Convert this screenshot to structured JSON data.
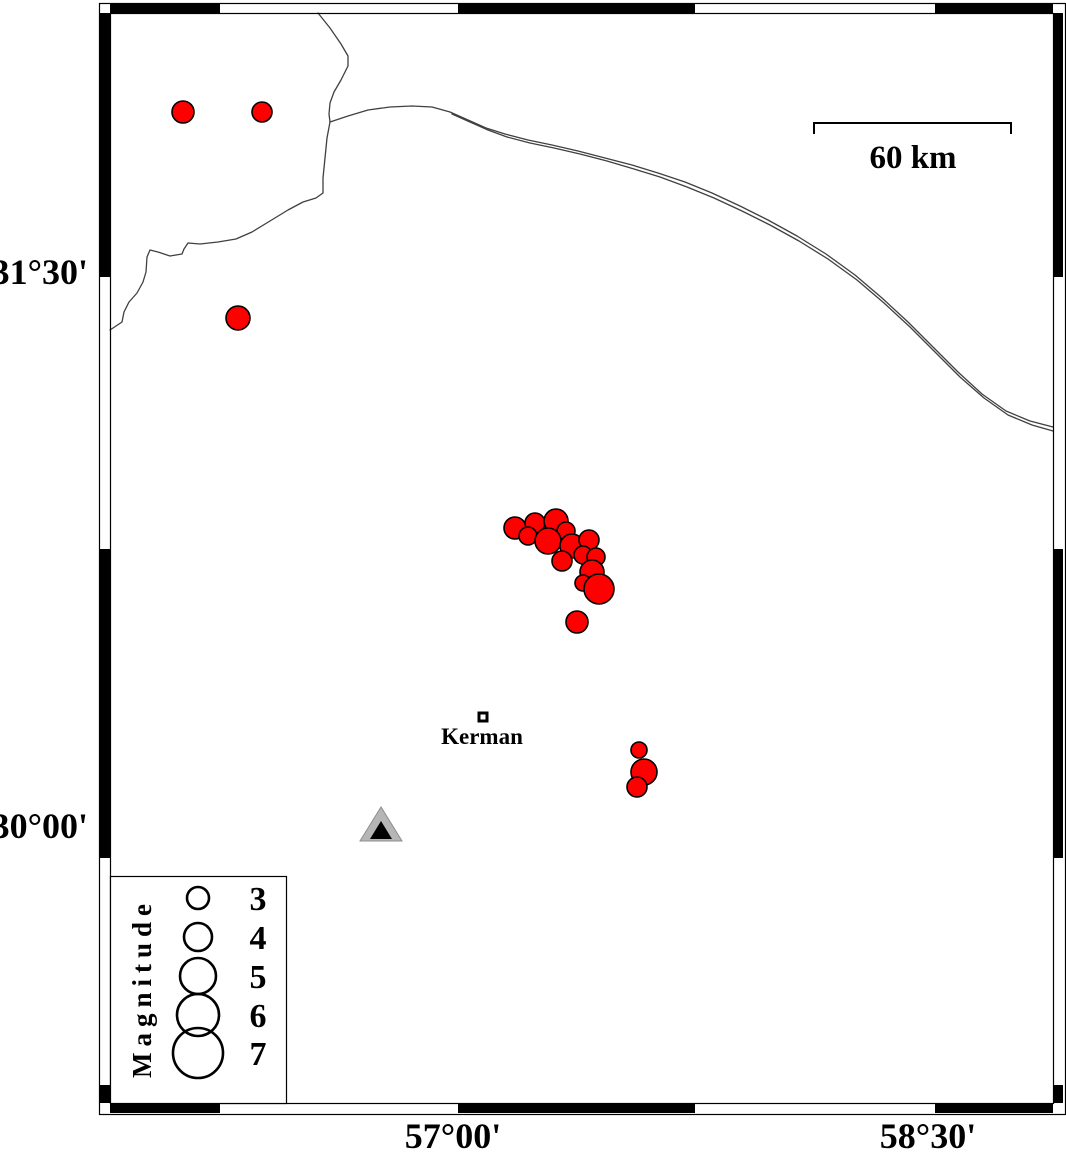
{
  "figure": {
    "width": 1066,
    "height": 1154,
    "background": "#ffffff"
  },
  "colors": {
    "epicenter_fill": "#ff0000",
    "epicenter_stroke": "#000000",
    "station_fill": "#b6b6b6",
    "station_inner": "#000000",
    "boundary_line": "#404040",
    "frame_black": "#000000",
    "frame_white": "#ffffff"
  },
  "frame": {
    "outer": {
      "x": 99,
      "y": 3,
      "w": 966,
      "h": 1111
    },
    "inner": {
      "x": 110,
      "y": 13,
      "w": 943,
      "h": 1090
    },
    "top_segments": [
      [
        110,
        220
      ],
      [
        458,
        695
      ],
      [
        935,
        1053
      ]
    ],
    "bottom_segments": [
      [
        110,
        220
      ],
      [
        458,
        695
      ],
      [
        935,
        1053
      ]
    ],
    "left_segments": [
      [
        13,
        277
      ],
      [
        549,
        858
      ],
      [
        1085,
        1103
      ]
    ],
    "right_segments": [
      [
        13,
        277
      ],
      [
        549,
        858
      ],
      [
        1085,
        1103
      ]
    ]
  },
  "axis": {
    "lat_labels": [
      {
        "text": "31°30'",
        "x": 88,
        "y": 284
      },
      {
        "text": "30°00'",
        "x": 88,
        "y": 838
      }
    ],
    "lon_labels": [
      {
        "text": "57°00'",
        "x": 453,
        "y": 1148
      },
      {
        "text": "58°30'",
        "x": 928,
        "y": 1148
      }
    ]
  },
  "scale_bar": {
    "label": "60 km",
    "x1": 814,
    "x2": 1011,
    "y": 123,
    "tick": 11,
    "label_x": 913,
    "label_y": 168
  },
  "city": {
    "label": "Kerman",
    "x": 483,
    "y": 717,
    "size": 8,
    "label_x": 482,
    "label_y": 744
  },
  "station": {
    "x": 381,
    "y": 828
  },
  "earthquakes": [
    [
      183,
      112,
      11
    ],
    [
      262,
      112,
      10
    ],
    [
      238,
      318,
      12
    ],
    [
      515,
      528,
      11
    ],
    [
      535,
      523,
      10
    ],
    [
      556,
      521,
      12
    ],
    [
      528,
      536,
      9
    ],
    [
      566,
      531,
      9
    ],
    [
      548,
      541,
      13
    ],
    [
      572,
      546,
      12
    ],
    [
      589,
      540,
      10
    ],
    [
      583,
      555,
      9
    ],
    [
      596,
      557,
      9
    ],
    [
      562,
      561,
      10
    ],
    [
      592,
      572,
      12
    ],
    [
      583,
      583,
      8
    ],
    [
      599,
      589,
      15
    ],
    [
      577,
      622,
      11
    ],
    [
      639,
      750,
      8
    ],
    [
      644,
      772,
      13
    ],
    [
      637,
      787,
      10
    ]
  ],
  "boundaries": [
    {
      "points": [
        [
          318,
          13
        ],
        [
          330,
          28
        ],
        [
          341,
          44
        ],
        [
          348,
          56
        ],
        [
          348,
          66
        ],
        [
          341,
          80
        ],
        [
          334,
          92
        ],
        [
          330,
          103
        ],
        [
          329,
          114
        ],
        [
          330,
          122
        ],
        [
          327,
          138
        ],
        [
          325,
          158
        ],
        [
          323,
          178
        ],
        [
          323,
          193
        ],
        [
          316,
          198
        ],
        [
          303,
          202
        ],
        [
          288,
          210
        ],
        [
          270,
          221
        ],
        [
          252,
          232
        ],
        [
          236,
          239
        ],
        [
          218,
          242
        ],
        [
          200,
          244
        ],
        [
          188,
          243
        ],
        [
          184,
          249
        ],
        [
          182,
          254
        ],
        [
          170,
          256
        ],
        [
          158,
          252
        ],
        [
          150,
          250
        ],
        [
          147,
          257
        ],
        [
          146,
          272
        ],
        [
          143,
          282
        ],
        [
          137,
          293
        ],
        [
          129,
          302
        ],
        [
          124,
          312
        ],
        [
          122,
          322
        ],
        [
          116,
          326
        ],
        [
          110,
          330
        ]
      ]
    },
    {
      "points": [
        [
          330,
          122
        ],
        [
          348,
          116
        ],
        [
          368,
          110
        ],
        [
          390,
          107
        ],
        [
          412,
          106
        ],
        [
          432,
          107
        ],
        [
          450,
          112
        ],
        [
          468,
          120
        ],
        [
          486,
          128
        ],
        [
          505,
          134
        ],
        [
          528,
          140
        ],
        [
          552,
          145
        ],
        [
          578,
          151
        ],
        [
          605,
          158
        ],
        [
          632,
          165
        ],
        [
          658,
          173
        ],
        [
          685,
          182
        ],
        [
          712,
          193
        ],
        [
          740,
          206
        ],
        [
          768,
          220
        ],
        [
          797,
          236
        ],
        [
          826,
          254
        ],
        [
          855,
          275
        ],
        [
          882,
          298
        ],
        [
          908,
          322
        ],
        [
          933,
          347
        ],
        [
          958,
          372
        ],
        [
          982,
          394
        ],
        [
          1006,
          411
        ],
        [
          1030,
          421
        ],
        [
          1053,
          427
        ]
      ]
    },
    {
      "points": [
        [
          452,
          114
        ],
        [
          470,
          122
        ],
        [
          488,
          130
        ],
        [
          507,
          137
        ],
        [
          530,
          143
        ],
        [
          554,
          148
        ],
        [
          580,
          154
        ],
        [
          607,
          161
        ],
        [
          634,
          169
        ],
        [
          660,
          177
        ],
        [
          687,
          187
        ],
        [
          714,
          198
        ],
        [
          742,
          211
        ],
        [
          770,
          225
        ],
        [
          799,
          241
        ],
        [
          828,
          259
        ],
        [
          857,
          280
        ],
        [
          884,
          303
        ],
        [
          910,
          327
        ],
        [
          935,
          352
        ],
        [
          960,
          377
        ],
        [
          984,
          398
        ],
        [
          1008,
          415
        ],
        [
          1032,
          425
        ],
        [
          1053,
          431
        ]
      ]
    }
  ],
  "legend": {
    "title": "Magnitude",
    "box": {
      "x": 110,
      "y": 876,
      "w": 176,
      "h": 227
    },
    "title_x": 142,
    "title_y": 988,
    "circle_x": 198,
    "label_x": 258,
    "entries": [
      {
        "label": "3",
        "cy": 898,
        "r": 11
      },
      {
        "label": "4",
        "cy": 937,
        "r": 14
      },
      {
        "label": "5",
        "cy": 976,
        "r": 18
      },
      {
        "label": "6",
        "cy": 1015,
        "r": 21
      },
      {
        "label": "7",
        "cy": 1053,
        "r": 25
      }
    ]
  }
}
